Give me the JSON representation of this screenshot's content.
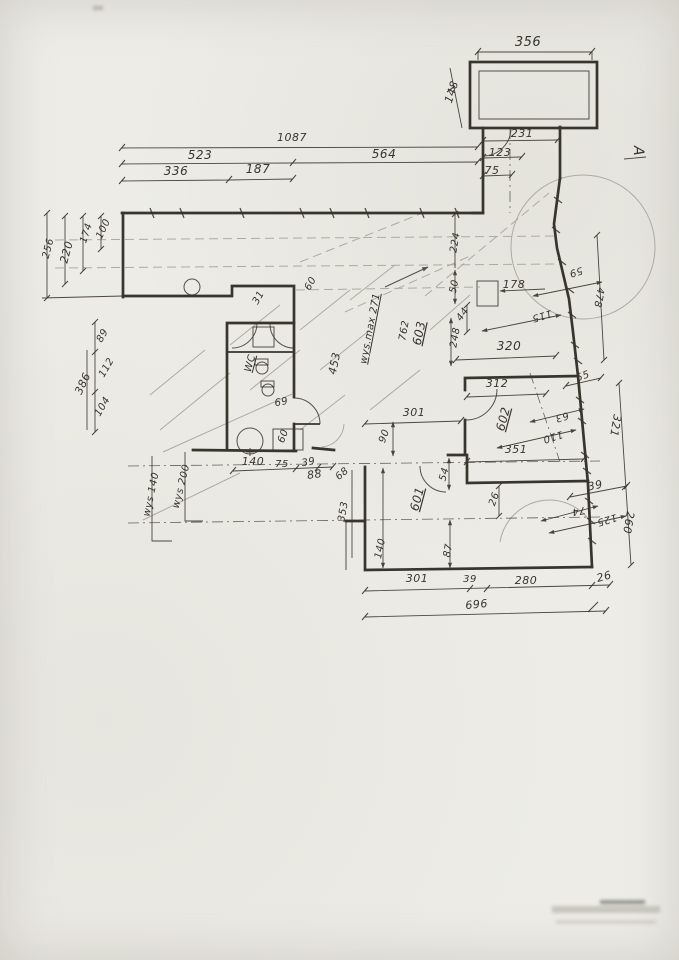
{
  "document": {
    "kind": "hand-drawn architectural floor plan (scan)",
    "paper_color": "#edece6",
    "ink_color": "#38352d",
    "pencil_color": "#aeaaa0"
  },
  "section_marker": {
    "label": "A",
    "x": 634,
    "y": 151,
    "rot": 90,
    "size": 14
  },
  "room_labels": [
    {
      "text": "WC",
      "x": 253,
      "y": 364,
      "rot": -75,
      "size": 10,
      "u": true
    },
    {
      "text": "603",
      "x": 423,
      "y": 334,
      "rot": -78,
      "size": 12,
      "u": true
    },
    {
      "text": "602",
      "x": 507,
      "y": 420,
      "rot": -75,
      "size": 12,
      "u": true
    },
    {
      "text": "601",
      "x": 421,
      "y": 500,
      "rot": -75,
      "size": 12,
      "u": true
    }
  ],
  "height_annotations": [
    {
      "text": "wys.max 271",
      "x": 373,
      "y": 329,
      "rot": -79,
      "size": 10,
      "u": true
    },
    {
      "text": "wys 140",
      "x": 154,
      "y": 495,
      "rot": -78,
      "size": 10
    },
    {
      "text": "wys 200",
      "x": 184,
      "y": 487,
      "rot": -76,
      "size": 10
    }
  ],
  "dimension_labels": [
    {
      "text": "356",
      "x": 528,
      "y": 46,
      "rot": 0,
      "size": 13
    },
    {
      "text": "148",
      "x": 455,
      "y": 93,
      "rot": -72,
      "size": 11
    },
    {
      "text": "231",
      "x": 522,
      "y": 137,
      "rot": 0,
      "size": 11
    },
    {
      "text": "123",
      "x": 500,
      "y": 156,
      "rot": 0,
      "size": 11
    },
    {
      "text": "75",
      "x": 492,
      "y": 174,
      "rot": 0,
      "size": 11
    },
    {
      "text": "1087",
      "x": 292,
      "y": 141,
      "rot": 0,
      "size": 11
    },
    {
      "text": "523",
      "x": 200,
      "y": 159,
      "rot": 0,
      "size": 12
    },
    {
      "text": "564",
      "x": 384,
      "y": 158,
      "rot": 0,
      "size": 12
    },
    {
      "text": "336",
      "x": 176,
      "y": 175,
      "rot": 0,
      "size": 12
    },
    {
      "text": "187",
      "x": 258,
      "y": 173,
      "rot": 0,
      "size": 12
    },
    {
      "text": "100",
      "x": 106,
      "y": 230,
      "rot": -65,
      "size": 10
    },
    {
      "text": "174",
      "x": 89,
      "y": 234,
      "rot": -72,
      "size": 10
    },
    {
      "text": "220",
      "x": 70,
      "y": 253,
      "rot": -75,
      "size": 11
    },
    {
      "text": "256",
      "x": 51,
      "y": 249,
      "rot": -75,
      "size": 10
    },
    {
      "text": "89",
      "x": 105,
      "y": 337,
      "rot": -60,
      "size": 10
    },
    {
      "text": "112",
      "x": 109,
      "y": 369,
      "rot": -60,
      "size": 10
    },
    {
      "text": "386",
      "x": 86,
      "y": 385,
      "rot": -65,
      "size": 11
    },
    {
      "text": "104",
      "x": 105,
      "y": 408,
      "rot": -60,
      "size": 10
    },
    {
      "text": "31",
      "x": 261,
      "y": 299,
      "rot": -60,
      "size": 10
    },
    {
      "text": "60",
      "x": 313,
      "y": 285,
      "rot": -60,
      "size": 10
    },
    {
      "text": "224",
      "x": 458,
      "y": 243,
      "rot": -80,
      "size": 10
    },
    {
      "text": "50",
      "x": 457,
      "y": 287,
      "rot": -78,
      "size": 10
    },
    {
      "text": "178",
      "x": 514,
      "y": 288,
      "rot": 0,
      "size": 11
    },
    {
      "text": "44",
      "x": 465,
      "y": 316,
      "rot": -55,
      "size": 10
    },
    {
      "text": "248",
      "x": 458,
      "y": 338,
      "rot": -80,
      "size": 10
    },
    {
      "text": "59",
      "x": 575,
      "y": 269,
      "rot": 163,
      "size": 10
    },
    {
      "text": "478",
      "x": 596,
      "y": 297,
      "rot": 100,
      "size": 10
    },
    {
      "text": "115",
      "x": 541,
      "y": 313,
      "rot": 163,
      "size": 10
    },
    {
      "text": "320",
      "x": 509,
      "y": 350,
      "rot": 0,
      "size": 12
    },
    {
      "text": "55",
      "x": 584,
      "y": 379,
      "rot": -20,
      "size": 10
    },
    {
      "text": "312",
      "x": 497,
      "y": 387,
      "rot": 0,
      "size": 11
    },
    {
      "text": "63",
      "x": 561,
      "y": 414,
      "rot": 163,
      "size": 10
    },
    {
      "text": "110",
      "x": 552,
      "y": 434,
      "rot": 163,
      "size": 10
    },
    {
      "text": "321",
      "x": 612,
      "y": 425,
      "rot": 100,
      "size": 11
    },
    {
      "text": "351",
      "x": 516,
      "y": 453,
      "rot": 0,
      "size": 11
    },
    {
      "text": "301",
      "x": 414,
      "y": 416,
      "rot": 0,
      "size": 11
    },
    {
      "text": "90",
      "x": 387,
      "y": 437,
      "rot": -70,
      "size": 10
    },
    {
      "text": "54",
      "x": 447,
      "y": 475,
      "rot": -75,
      "size": 10
    },
    {
      "text": "26",
      "x": 497,
      "y": 500,
      "rot": -70,
      "size": 10
    },
    {
      "text": "39",
      "x": 596,
      "y": 489,
      "rot": -12,
      "size": 11
    },
    {
      "text": "74",
      "x": 578,
      "y": 508,
      "rot": 170,
      "size": 10
    },
    {
      "text": "125",
      "x": 606,
      "y": 517,
      "rot": 163,
      "size": 10
    },
    {
      "text": "260",
      "x": 625,
      "y": 522,
      "rot": 100,
      "size": 11
    },
    {
      "text": "26",
      "x": 605,
      "y": 580,
      "rot": -15,
      "size": 11
    },
    {
      "text": "280",
      "x": 526,
      "y": 584,
      "rot": 0,
      "size": 11
    },
    {
      "text": "39",
      "x": 470,
      "y": 582,
      "rot": 0,
      "size": 10
    },
    {
      "text": "301",
      "x": 417,
      "y": 582,
      "rot": 0,
      "size": 11
    },
    {
      "text": "696",
      "x": 477,
      "y": 608,
      "rot": -6,
      "size": 11
    },
    {
      "text": "140",
      "x": 383,
      "y": 549,
      "rot": -78,
      "size": 10
    },
    {
      "text": "87",
      "x": 451,
      "y": 551,
      "rot": -80,
      "size": 10
    },
    {
      "text": "353",
      "x": 346,
      "y": 512,
      "rot": -80,
      "size": 10
    },
    {
      "text": "68",
      "x": 344,
      "y": 476,
      "rot": -40,
      "size": 10
    },
    {
      "text": "88",
      "x": 315,
      "y": 478,
      "rot": -8,
      "size": 11
    },
    {
      "text": "140",
      "x": 253,
      "y": 465,
      "rot": 0,
      "size": 11
    },
    {
      "text": "75",
      "x": 282,
      "y": 467,
      "rot": 0,
      "size": 10
    },
    {
      "text": "39",
      "x": 309,
      "y": 465,
      "rot": -10,
      "size": 10
    },
    {
      "text": "69",
      "x": 282,
      "y": 405,
      "rot": -12,
      "size": 10
    },
    {
      "text": "60",
      "x": 286,
      "y": 437,
      "rot": -70,
      "size": 10
    },
    {
      "text": "453",
      "x": 338,
      "y": 364,
      "rot": -78,
      "size": 11
    },
    {
      "text": "762",
      "x": 407,
      "y": 331,
      "rot": -80,
      "size": 10
    }
  ]
}
